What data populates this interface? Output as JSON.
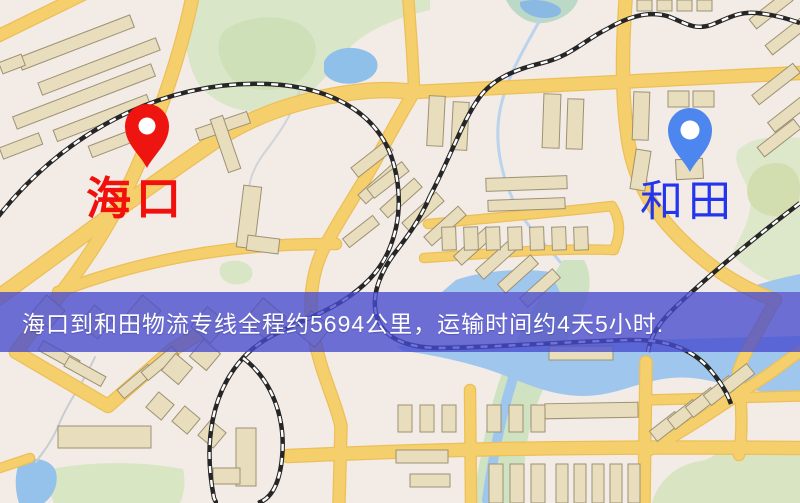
{
  "banner": {
    "text": "海口到和田物流专线全程约5694公里，运输时间约4天5小时."
  },
  "markers": [
    {
      "id": "origin",
      "label": "海口",
      "color": "#ee1410",
      "label_color": "#f2100c",
      "x": 147,
      "y": 168,
      "label_x": 86,
      "label_y": 176,
      "label_size": 45,
      "label_weight": 700
    },
    {
      "id": "destination",
      "label": "和田",
      "color": "#4c86ee",
      "label_color": "#2336ee",
      "x": 690,
      "y": 172,
      "label_x": 640,
      "label_y": 181,
      "label_size": 43,
      "label_weight": 400
    }
  ],
  "map": {
    "colors": {
      "background": "#f3ebe6",
      "road": "#f6cf6d",
      "road_casing": "#ecbf58",
      "building": "#e8ddbd",
      "building_stroke": "#9d9173",
      "green": "#d9e6c8",
      "water": "#9fc7ee",
      "railway_dark": "#262626",
      "railway_light": "#ffffff"
    },
    "greens": [
      {
        "d": "M 196,0 L 430,0 L 430,10 C 386,20 358,36 344,54 C 330,72 320,86 302,98 C 272,118 232,116 206,92 C 188,76 182,40 186,0 Z"
      },
      {
        "d": "M 225,30 C 245,15 285,12 305,28 C 322,42 318,65 300,80 C 278,96 240,92 228,74 C 218,60 214,42 225,30 Z",
        "fill": "#cee0b8"
      },
      {
        "d": "M 506,0 L 578,0 C 574,12 560,21 544,23 C 527,25 512,13 506,0 Z",
        "fill": "#bcd9c8"
      },
      {
        "d": "M 800,138 L 800,292 C 772,284 748,272 732,254 C 742,232 756,212 748,190 C 742,172 732,162 738,150 C 752,136 776,136 800,138 Z",
        "fill": "#dde8cb"
      },
      {
        "d": "M 768,164 C 786,160 798,168 800,186 C 802,206 790,218 772,216 C 754,214 744,200 748,184 C 751,172 758,166 768,164 Z",
        "fill": "#d2deb0"
      },
      {
        "d": "M 563,260 C 544,290 524,322 508,358 C 496,386 488,418 482,450 C 478,472 474,488 471,503 L 524,503 C 522,462 528,422 542,392 C 557,360 574,330 586,302 C 592,286 590,270 584,260 Z",
        "fill": "#cfe2c2"
      },
      {
        "d": "M 46,470 C 90,461 140,461 183,469 C 186,483 184,494 180,503 L 54,503 C 49,492 46,481 46,470 Z",
        "fill": "#d8e6c4"
      },
      {
        "d": "M 652,503 C 658,480 678,464 700,461 C 716,459 723,444 739,441 C 756,437 764,449 780,451 C 789,452 796,447 800,444 L 800,503 Z",
        "fill": "#d9e5c2"
      },
      {
        "d": "M 222,264 C 232,258 248,260 252,270 C 255,280 244,286 232,284 C 222,282 216,272 222,264 Z",
        "fill": "#d8e6c6"
      }
    ],
    "waters": [
      {
        "d": "M 324,62 C 330,48 352,44 368,52 C 382,59 380,74 366,80 C 350,87 330,84 324,72 Z",
        "fill": "#8fc0ea"
      },
      {
        "d": "M 520,2 C 532,-2 552,0 560,8 C 564,14 556,18 544,18 C 532,18 518,10 520,2 Z",
        "fill": "#8ab9e4"
      },
      {
        "d": "M 396,346 L 800,336 L 800,398 C 758,392 728,384 700,379 C 658,372 630,391 598,395 C 558,400 528,384 498,373 C 468,362 428,354 404,351 Z"
      },
      {
        "d": "M 442,292 L 560,292 L 550,272 C 518,267 478,272 456,280 Z"
      },
      {
        "d": "M 736,292 L 800,292 L 800,274 C 776,279 754,285 736,292 Z"
      },
      {
        "d": "M 20,461 C 39,456 52,461 56,472 C 59,486 52,497 44,503 L 19,503 C 14,488 15,472 20,461 Z",
        "fill": "#95c2ea"
      }
    ],
    "streams": [
      {
        "d": "M 540,20 C 522,52 504,82 499,116 C 495,146 502,176 514,202 C 528,230 548,246 560,262",
        "color": "#b9d4ec",
        "w": 3
      },
      {
        "d": "M 300,90 C 292,115 280,132 268,148 C 252,168 246,186 250,205",
        "color": "#cfd4d8",
        "w": 2
      },
      {
        "d": "M 95,357 C 84,382 68,402 60,422 C 52,442 43,452 36,462",
        "color": "#c8cdd4",
        "w": 2
      },
      {
        "d": "M 517,366 C 504,404 494,448 487,500",
        "color": "#9fc7ee",
        "w": 10
      }
    ],
    "roads": [
      {
        "d": "M -6,38 L 88,-8",
        "w": 11
      },
      {
        "d": "M 193,-6 C 181,55 160,112 141,158 C 122,203 98,245 62,292",
        "w": 12
      },
      {
        "d": "M 62,292 C 45,315 30,333 16,352",
        "w": 12
      },
      {
        "d": "M 16,352 L 108,406 L 172,350 L 205,330",
        "w": 12
      },
      {
        "d": "M -8,302 C 70,246 140,192 205,148 C 248,116 300,99 356,92 C 378,89 396,90 414,92",
        "w": 14
      },
      {
        "d": "M 414,92 L 800,73",
        "w": 12
      },
      {
        "d": "M 414,92 C 396,122 381,152 363,182 C 346,210 333,230 322,252 C 305,290 310,330 322,368 C 330,393 337,408 341,426",
        "w": 11
      },
      {
        "d": "M 341,426 L 339,503",
        "w": 11
      },
      {
        "d": "M 626,-6 C 622,48 621,98 629,146 C 637,190 662,224 697,254 C 722,276 748,290 775,300",
        "w": 12
      },
      {
        "d": "M 775,300 C 760,330 745,350 738,372 C 742,405 743,432 739,455",
        "w": 10
      },
      {
        "d": "M 408,-6 L 412,50 C 413,70 414,80 414,92",
        "w": 10
      },
      {
        "d": "M 428,224 C 492,218 550,213 612,206 C 622,222 620,236 614,250",
        "w": 8
      },
      {
        "d": "M 424,258 C 495,253 555,248 614,250",
        "w": 8
      },
      {
        "d": "M 58,292 C 150,256 245,243 336,244",
        "w": 10
      },
      {
        "d": "M 288,456 C 420,450 560,446 800,448",
        "w": 12
      },
      {
        "d": "M -6,470 L 30,458",
        "w": 8
      },
      {
        "d": "M 470,390 L 471,503",
        "w": 10
      },
      {
        "d": "M 646,362 L 644,503",
        "w": 11
      },
      {
        "d": "M 646,400 L 800,396",
        "w": 9
      },
      {
        "d": "M 646,452 C 690,428 730,400 772,372 C 785,362 795,355 805,348",
        "w": 10
      }
    ],
    "buildings": [
      [
        16,
        36,
        120,
        13,
        -21
      ],
      [
        36,
        60,
        126,
        13,
        -21
      ],
      [
        10,
        90,
        148,
        13,
        -21
      ],
      [
        52,
        112,
        100,
        12,
        -21
      ],
      [
        88,
        133,
        72,
        12,
        -21
      ],
      [
        0,
        58,
        24,
        12,
        -21
      ],
      [
        0,
        140,
        42,
        12,
        -21
      ],
      [
        196,
        120,
        54,
        12,
        -19
      ],
      [
        219,
        116,
        13,
        56,
        -19
      ],
      [
        240,
        186,
        18,
        62,
        7
      ],
      [
        247,
        237,
        32,
        15,
        7
      ],
      [
        356,
        178,
        46,
        12,
        -42
      ],
      [
        378,
        192,
        46,
        12,
        -42
      ],
      [
        400,
        206,
        46,
        12,
        -42
      ],
      [
        422,
        220,
        46,
        12,
        -42
      ],
      [
        452,
        240,
        44,
        12,
        -42
      ],
      [
        474,
        254,
        44,
        12,
        -42
      ],
      [
        496,
        268,
        44,
        12,
        -42
      ],
      [
        518,
        282,
        44,
        12,
        -42
      ],
      [
        428,
        96,
        16,
        50,
        3
      ],
      [
        452,
        102,
        16,
        48,
        3
      ],
      [
        543,
        94,
        17,
        54,
        2
      ],
      [
        567,
        99,
        16,
        50,
        2
      ],
      [
        637,
        0,
        15,
        11,
        0
      ],
      [
        657,
        0,
        15,
        11,
        0
      ],
      [
        677,
        0,
        15,
        11,
        0
      ],
      [
        697,
        0,
        15,
        11,
        0
      ],
      [
        748,
        4,
        46,
        12,
        -38
      ],
      [
        764,
        30,
        46,
        12,
        -38
      ],
      [
        750,
        78,
        52,
        12,
        -38
      ],
      [
        766,
        106,
        50,
        12,
        -38
      ],
      [
        756,
        132,
        46,
        12,
        -38
      ],
      [
        633,
        92,
        16,
        48,
        2
      ],
      [
        668,
        91,
        21,
        16,
        0
      ],
      [
        693,
        91,
        21,
        16,
        0
      ],
      [
        676,
        159,
        27,
        20,
        -3
      ],
      [
        633,
        150,
        15,
        40,
        9
      ],
      [
        486,
        177,
        81,
        13,
        -2
      ],
      [
        488,
        199,
        77,
        11,
        -2
      ],
      [
        442,
        227,
        14,
        23,
        -2
      ],
      [
        464,
        227,
        14,
        23,
        -2
      ],
      [
        486,
        227,
        14,
        23,
        -2
      ],
      [
        508,
        227,
        14,
        23,
        -2
      ],
      [
        530,
        227,
        14,
        23,
        -2
      ],
      [
        552,
        227,
        14,
        23,
        -2
      ],
      [
        574,
        227,
        14,
        23,
        -2
      ],
      [
        350,
        153,
        44,
        12,
        -38
      ],
      [
        366,
        174,
        44,
        12,
        -38
      ],
      [
        342,
        226,
        38,
        11,
        -38
      ],
      [
        36,
        300,
        24,
        24,
        40
      ],
      [
        84,
        310,
        24,
        24,
        40
      ],
      [
        132,
        300,
        24,
        24,
        40
      ],
      [
        196,
        312,
        26,
        26,
        40
      ],
      [
        250,
        304,
        30,
        30,
        40
      ],
      [
        300,
        316,
        26,
        26,
        40
      ],
      [
        38,
        350,
        42,
        11,
        29
      ],
      [
        64,
        366,
        42,
        11,
        29
      ],
      [
        116,
        376,
        40,
        11,
        -40
      ],
      [
        140,
        358,
        40,
        11,
        -40
      ],
      [
        166,
        358,
        22,
        22,
        40
      ],
      [
        194,
        344,
        22,
        22,
        40
      ],
      [
        150,
        396,
        20,
        20,
        40
      ],
      [
        176,
        410,
        20,
        20,
        40
      ],
      [
        202,
        424,
        20,
        20,
        40
      ],
      [
        58,
        426,
        93,
        22,
        0
      ],
      [
        236,
        428,
        20,
        58,
        0
      ],
      [
        213,
        468,
        27,
        16,
        0
      ],
      [
        398,
        405,
        14,
        27,
        0
      ],
      [
        420,
        405,
        14,
        27,
        0
      ],
      [
        442,
        405,
        14,
        27,
        0
      ],
      [
        487,
        405,
        14,
        27,
        0
      ],
      [
        509,
        405,
        14,
        27,
        0
      ],
      [
        531,
        405,
        14,
        27,
        0
      ],
      [
        545,
        403,
        93,
        15,
        -1
      ],
      [
        549,
        346,
        64,
        14,
        0
      ],
      [
        489,
        464,
        14,
        39,
        0
      ],
      [
        510,
        464,
        14,
        39,
        0
      ],
      [
        531,
        464,
        14,
        39,
        0
      ],
      [
        556,
        464,
        12,
        39,
        0
      ],
      [
        574,
        464,
        12,
        39,
        0
      ],
      [
        592,
        464,
        12,
        39,
        0
      ],
      [
        610,
        464,
        12,
        39,
        0
      ],
      [
        628,
        464,
        12,
        39,
        0
      ],
      [
        396,
        450,
        52,
        13,
        0
      ],
      [
        410,
        474,
        40,
        13,
        0
      ],
      [
        650,
        420,
        32,
        13,
        -38
      ],
      [
        668,
        408,
        32,
        13,
        -38
      ],
      [
        686,
        396,
        32,
        13,
        -38
      ],
      [
        704,
        384,
        32,
        13,
        -38
      ],
      [
        722,
        372,
        32,
        13,
        -38
      ]
    ],
    "railways": [
      {
        "d": "M -6,222 C 60,135 160,80 268,84 C 340,87 382,120 394,165 C 402,196 400,225 388,252 C 378,274 362,288 344,300 C 310,322 268,330 243,358 C 212,392 203,442 214,498 C 216,503 217,503 218,503"
      },
      {
        "d": "M 243,358 C 272,380 286,418 282,458 C 279,489 268,500 258,503"
      },
      {
        "d": "M 430,196 C 450,158 463,120 479,98 C 493,78 517,69 542,63 C 571,56 583,41 607,29 C 629,16 649,11 667,16 C 682,21 693,31 711,25 C 727,19 738,11 757,13 C 776,15 788,19 800,23"
      },
      {
        "d": "M 430,196 C 420,220 407,237 394,254 C 378,276 370,300 378,320 C 386,340 410,348 440,348 C 500,347 560,342 630,340 C 672,339 696,352 712,372 C 722,384 728,395 731,404"
      },
      {
        "d": "M 800,203 C 762,232 725,262 694,290 C 672,310 652,326 648,352"
      }
    ]
  }
}
